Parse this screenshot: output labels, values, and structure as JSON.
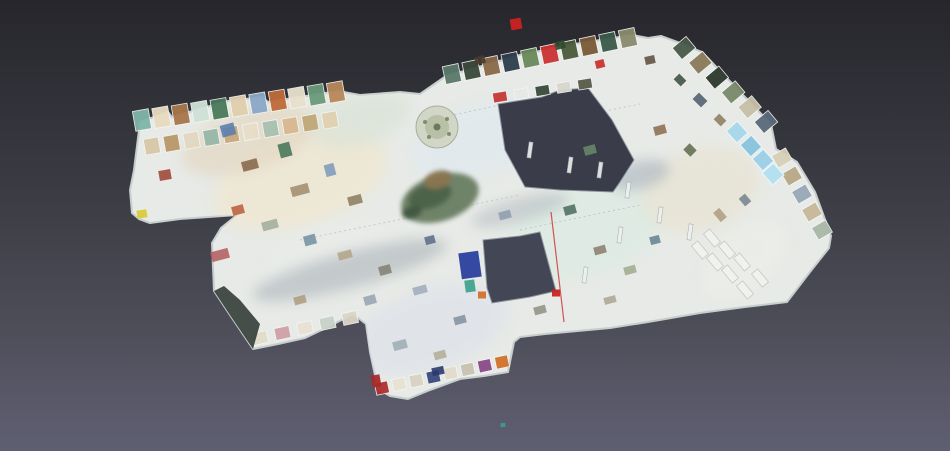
{
  "viewer": {
    "type": "3d-dollhouse-mesh-view",
    "background": {
      "top": "#26262c",
      "upper_mid": "#3a3a42",
      "lower_mid": "#4c4c57",
      "bottom": "#5f5f72"
    },
    "model_accent_colors": {
      "floor": "#e7eae6",
      "wall_edge": "#c6cdcd",
      "atrium_hole": "#3a3d49",
      "courtyard_hole": "#434654",
      "glass_roof": "#9ed0e6",
      "grotto_green": "#64785c",
      "alert_red": "#cc2222"
    }
  },
  "scene": {
    "plate": {
      "fill": "#e7eae6",
      "stroke": "#c6cdcd",
      "points": "140,122 168,112 172,117 210,106 228,101 262,97 268,102 338,91 360,95 400,92 420,94 446,76 475,68 520,55 575,44 632,35 648,38 661,36 680,43 702,52 744,96 771,124 776,149 797,162 815,192 831,236 829,248 810,272 787,302 745,307 700,313 648,322 610,328 545,334 520,337 514,342 508,372 484,376 460,379 430,390 408,399 390,396 378,389 370,352 366,324 353,314 330,326 305,338 278,344 253,349 232,318 214,291 212,243 221,228 237,215 180,219 150,223 139,219 132,213 130,190 134,170"
    },
    "holes": [
      {
        "name": "atrium-hole",
        "fill": "#3a3d49",
        "points": "498,104 542,97 560,90 588,88 612,120 634,160 620,182 613,192 560,190 525,187 505,150"
      },
      {
        "name": "courtyard-hole",
        "fill": "#434654",
        "points": "483,240 520,236 540,232 553,280 556,291 530,297 492,303 487,288"
      }
    ],
    "corner_face": {
      "fill": "#333d36",
      "opacity": 0.9,
      "points": "214,291 232,318 253,349 260,324 240,300 224,286"
    },
    "tint_blobs": [
      {
        "cx": 300,
        "cy": 180,
        "rx": 90,
        "ry": 45,
        "rot": -18,
        "fill": "#efe7d2",
        "op": 0.8
      },
      {
        "cx": 250,
        "cy": 140,
        "rx": 70,
        "ry": 30,
        "rot": -18,
        "fill": "#e3d7c2",
        "op": 0.7
      },
      {
        "cx": 480,
        "cy": 140,
        "rx": 70,
        "ry": 35,
        "rot": -18,
        "fill": "#dfe9f0",
        "op": 0.7
      },
      {
        "cx": 585,
        "cy": 230,
        "rx": 80,
        "ry": 45,
        "rot": -18,
        "fill": "#dcebe3",
        "op": 0.8
      },
      {
        "cx": 700,
        "cy": 190,
        "rx": 60,
        "ry": 40,
        "rot": -18,
        "fill": "#e8e3d2",
        "op": 0.7
      },
      {
        "cx": 430,
        "cy": 330,
        "rx": 80,
        "ry": 40,
        "rot": -18,
        "fill": "#dfe3ea",
        "op": 0.8
      },
      {
        "cx": 330,
        "cy": 260,
        "rx": 70,
        "ry": 35,
        "rot": -18,
        "fill": "#e9ecea",
        "op": 0.6
      },
      {
        "cx": 745,
        "cy": 260,
        "rx": 50,
        "ry": 28,
        "rot": -40,
        "fill": "#eceee9",
        "op": 0.7
      },
      {
        "cx": 360,
        "cy": 120,
        "rx": 50,
        "ry": 25,
        "rot": -18,
        "fill": "#d8e2d4",
        "op": 0.6
      },
      {
        "cx": 350,
        "cy": 270,
        "rx": 100,
        "ry": 18,
        "rot": -15,
        "fill": "#9aa2ab",
        "op": 0.45
      },
      {
        "cx": 520,
        "cy": 210,
        "rx": 50,
        "ry": 12,
        "rot": -15,
        "fill": "#a2a9b2",
        "op": 0.4
      },
      {
        "cx": 640,
        "cy": 175,
        "rx": 30,
        "ry": 14,
        "rot": -15,
        "fill": "#8a98a8",
        "op": 0.4
      }
    ],
    "seams": [
      {
        "x1": 300,
        "y1": 240,
        "x2": 520,
        "y2": 195
      },
      {
        "x1": 430,
        "y1": 120,
        "x2": 500,
        "y2": 105
      },
      {
        "x1": 520,
        "y1": 230,
        "x2": 640,
        "y2": 205
      },
      {
        "x1": 560,
        "y1": 120,
        "x2": 640,
        "y2": 104
      }
    ],
    "strips": [
      {
        "name": "left-wing-top-rooms",
        "x1": 142,
        "y1": 120,
        "x2": 336,
        "y2": 92,
        "w": 16,
        "h": 20,
        "rot": -10,
        "colors": [
          "#7fb6a8",
          "#e8dcc0",
          "#a8764a",
          "#cfe2d8",
          "#4a7a5a",
          "#e0cfae",
          "#8aa8c8",
          "#c06a3a",
          "#e8e0cc",
          "#6a9a7a",
          "#b8885a"
        ]
      },
      {
        "name": "left-wing-second-rooms",
        "x1": 152,
        "y1": 146,
        "x2": 330,
        "y2": 120,
        "w": 15,
        "h": 16,
        "rot": -10,
        "colors": [
          "#d8c8a8",
          "#b89868",
          "#e2d8c2",
          "#98b8a8",
          "#caa87a",
          "#e8ddc8",
          "#a8c0b0",
          "#d8b890",
          "#c0a878",
          "#e0d0b0"
        ]
      },
      {
        "name": "upper-gallery-rooms",
        "x1": 452,
        "y1": 74,
        "x2": 628,
        "y2": 38,
        "w": 16,
        "h": 18,
        "rot": -12,
        "colors": [
          "#5a7a6a",
          "#3a4a3a",
          "#8a6a4a",
          "#2e3e4e",
          "#6a8a5a",
          "#cc3333",
          "#4a5a3a",
          "#7a5a3a",
          "#3a5a4a",
          "#8a8a6a"
        ]
      },
      {
        "name": "right-wing-top-rooms",
        "x1": 684,
        "y1": 48,
        "x2": 766,
        "y2": 122,
        "w": 15,
        "h": 18,
        "rot": 50,
        "colors": [
          "#4a5a4a",
          "#8a7a5a",
          "#2e3a2e",
          "#7a8a6a",
          "#c8c0a8",
          "#5a6a7a"
        ]
      },
      {
        "name": "right-edge-rooms",
        "x1": 782,
        "y1": 158,
        "x2": 822,
        "y2": 230,
        "w": 14,
        "h": 16,
        "rot": 60,
        "colors": [
          "#d8d0b8",
          "#b8a888",
          "#98a8b8",
          "#c8b898",
          "#a8b8a8"
        ]
      },
      {
        "name": "south-annex-edge-rooms",
        "x1": 382,
        "y1": 388,
        "x2": 502,
        "y2": 362,
        "w": 13,
        "h": 12,
        "rot": -12,
        "colors": [
          "#b03030",
          "#e8e2d2",
          "#d8d2c2",
          "#3a4a7e",
          "#e2dccc",
          "#c8c2b2",
          "#8a4a8a",
          "#d2722a"
        ]
      },
      {
        "name": "southwest-corner-rooms",
        "x1": 260,
        "y1": 338,
        "x2": 350,
        "y2": 318,
        "w": 15,
        "h": 12,
        "rot": -12,
        "colors": [
          "#e2dccc",
          "#d0a0a8",
          "#e8e2d2",
          "#c8d2c8",
          "#dcd6c6"
        ]
      },
      {
        "name": "atrium-rim-rooms",
        "x1": 500,
        "y1": 97,
        "x2": 585,
        "y2": 84,
        "w": 14,
        "h": 10,
        "rot": -9,
        "colors": [
          "#c43a35",
          "#e8e8e8",
          "#3a4a3a",
          "#d8d8d0",
          "#5a5a4a"
        ]
      }
    ],
    "exhibits": [
      {
        "x": 228,
        "y": 130,
        "w": 14,
        "h": 12,
        "r": -15,
        "f": "#5a80b0",
        "o": 0.9
      },
      {
        "x": 250,
        "y": 165,
        "w": 16,
        "h": 10,
        "r": -15,
        "f": "#8a6a4e",
        "o": 0.9
      },
      {
        "x": 285,
        "y": 150,
        "w": 12,
        "h": 14,
        "r": -15,
        "f": "#49795c",
        "o": 0.9
      },
      {
        "x": 300,
        "y": 190,
        "w": 18,
        "h": 10,
        "r": -15,
        "f": "#a08a6a",
        "o": 0.85
      },
      {
        "x": 330,
        "y": 170,
        "w": 10,
        "h": 12,
        "r": -15,
        "f": "#7a98b8",
        "o": 0.85
      },
      {
        "x": 355,
        "y": 200,
        "w": 14,
        "h": 9,
        "r": -15,
        "f": "#8a7a5a",
        "o": 0.85
      },
      {
        "x": 238,
        "y": 210,
        "w": 12,
        "h": 9,
        "r": -15,
        "f": "#b85a3a",
        "o": 0.85
      },
      {
        "x": 270,
        "y": 225,
        "w": 16,
        "h": 9,
        "r": -15,
        "f": "#9aa89a",
        "o": 0.8
      },
      {
        "x": 310,
        "y": 240,
        "w": 12,
        "h": 10,
        "r": -15,
        "f": "#6a8a9a",
        "o": 0.8
      },
      {
        "x": 345,
        "y": 255,
        "w": 14,
        "h": 8,
        "r": -15,
        "f": "#b0a080",
        "o": 0.8
      },
      {
        "x": 385,
        "y": 270,
        "w": 12,
        "h": 9,
        "r": -15,
        "f": "#7a7a6a",
        "o": 0.8
      },
      {
        "x": 420,
        "y": 290,
        "w": 14,
        "h": 8,
        "r": -15,
        "f": "#98a8b8",
        "o": 0.8
      },
      {
        "x": 370,
        "y": 300,
        "w": 12,
        "h": 9,
        "r": -15,
        "f": "#8a98a8",
        "o": 0.75
      },
      {
        "x": 300,
        "y": 300,
        "w": 12,
        "h": 8,
        "r": -15,
        "f": "#a89878",
        "o": 0.8
      },
      {
        "x": 430,
        "y": 240,
        "w": 10,
        "h": 8,
        "r": -15,
        "f": "#5a6a8a",
        "o": 0.85
      },
      {
        "x": 505,
        "y": 215,
        "w": 12,
        "h": 8,
        "r": -15,
        "f": "#8a9aaa",
        "o": 0.8
      },
      {
        "x": 570,
        "y": 210,
        "w": 12,
        "h": 9,
        "r": -15,
        "f": "#4a6a5a",
        "o": 0.85
      },
      {
        "x": 600,
        "y": 250,
        "w": 12,
        "h": 8,
        "r": -15,
        "f": "#8a7a6a",
        "o": 0.85
      },
      {
        "x": 630,
        "y": 270,
        "w": 12,
        "h": 8,
        "r": -15,
        "f": "#98a888",
        "o": 0.8
      },
      {
        "x": 655,
        "y": 240,
        "w": 10,
        "h": 8,
        "r": -15,
        "f": "#5a7a8a",
        "o": 0.8
      },
      {
        "x": 610,
        "y": 300,
        "w": 12,
        "h": 7,
        "r": -15,
        "f": "#a8a090",
        "o": 0.8
      },
      {
        "x": 540,
        "y": 310,
        "w": 12,
        "h": 8,
        "r": -15,
        "f": "#8a8a7a",
        "o": 0.8
      },
      {
        "x": 460,
        "y": 320,
        "w": 12,
        "h": 8,
        "r": -15,
        "f": "#7a8a98",
        "o": 0.8
      },
      {
        "x": 400,
        "y": 345,
        "w": 14,
        "h": 9,
        "r": -15,
        "f": "#9aa8b0",
        "o": 0.8
      },
      {
        "x": 440,
        "y": 355,
        "w": 12,
        "h": 8,
        "r": -15,
        "f": "#b0a890",
        "o": 0.8
      },
      {
        "x": 590,
        "y": 150,
        "w": 12,
        "h": 9,
        "r": -15,
        "f": "#6a8a6a",
        "o": 0.85
      },
      {
        "x": 660,
        "y": 130,
        "w": 12,
        "h": 9,
        "r": -15,
        "f": "#8a6a4a",
        "o": 0.85
      },
      {
        "x": 690,
        "y": 150,
        "w": 10,
        "h": 9,
        "r": 45,
        "f": "#5a6a4a",
        "o": 0.85
      },
      {
        "x": 700,
        "y": 100,
        "w": 12,
        "h": 9,
        "r": 45,
        "f": "#4a5a6a",
        "o": 0.85
      },
      {
        "x": 720,
        "y": 120,
        "w": 10,
        "h": 8,
        "r": 45,
        "f": "#8a7a5a",
        "o": 0.85
      },
      {
        "x": 680,
        "y": 80,
        "w": 10,
        "h": 8,
        "r": 45,
        "f": "#3a4a3a",
        "o": 0.85
      },
      {
        "x": 650,
        "y": 60,
        "w": 10,
        "h": 8,
        "r": -12,
        "f": "#5a4a3a",
        "o": 0.85
      },
      {
        "x": 720,
        "y": 215,
        "w": 12,
        "h": 8,
        "r": 50,
        "f": "#a89878",
        "o": 0.8
      },
      {
        "x": 745,
        "y": 200,
        "w": 10,
        "h": 8,
        "r": 50,
        "f": "#6a7a8a",
        "o": 0.8
      },
      {
        "x": 165,
        "y": 175,
        "w": 12,
        "h": 10,
        "r": -10,
        "f": "#a04a3a",
        "o": 0.9
      },
      {
        "x": 220,
        "y": 255,
        "w": 18,
        "h": 10,
        "r": -15,
        "f": "#b05a5a",
        "o": 0.85
      },
      {
        "x": 142,
        "y": 214,
        "w": 10,
        "h": 8,
        "r": -10,
        "f": "#d8cc3a",
        "o": 0.95
      },
      {
        "x": 482,
        "y": 295,
        "w": 8,
        "h": 7,
        "r": 0,
        "f": "#d2722a",
        "o": 0.95
      },
      {
        "x": 470,
        "y": 265,
        "w": 20,
        "h": 26,
        "r": -8,
        "f": "#2b3f9e",
        "o": 0.95
      },
      {
        "x": 470,
        "y": 286,
        "w": 10,
        "h": 12,
        "r": -8,
        "f": "#3aa08a",
        "o": 0.9
      },
      {
        "x": 516,
        "y": 24,
        "w": 11,
        "h": 11,
        "r": -10,
        "f": "#cc2222",
        "o": 0.95
      },
      {
        "x": 600,
        "y": 64,
        "w": 9,
        "h": 8,
        "r": -14,
        "f": "#cc3333",
        "o": 0.95
      },
      {
        "x": 556,
        "y": 293,
        "w": 8,
        "h": 7,
        "r": 0,
        "f": "#cc2222",
        "o": 0.95
      },
      {
        "x": 376,
        "y": 381,
        "w": 9,
        "h": 12,
        "r": -10,
        "f": "#a82a2a",
        "o": 0.95
      },
      {
        "x": 438,
        "y": 371,
        "w": 12,
        "h": 8,
        "r": -12,
        "f": "#2a3a6e",
        "o": 0.9
      },
      {
        "x": 503,
        "y": 425,
        "w": 5,
        "h": 4,
        "r": 0,
        "f": "#3aa08a",
        "o": 0.9
      },
      {
        "x": 560,
        "y": 45,
        "w": 10,
        "h": 8,
        "r": -14,
        "f": "#2e4a2e",
        "o": 0.9
      },
      {
        "x": 480,
        "y": 60,
        "w": 10,
        "h": 8,
        "r": -14,
        "f": "#4a3a2e",
        "o": 0.9
      }
    ],
    "wall_slivers": [
      {
        "x": 628,
        "y": 190
      },
      {
        "x": 600,
        "y": 170
      },
      {
        "x": 660,
        "y": 215
      },
      {
        "x": 690,
        "y": 232
      },
      {
        "x": 570,
        "y": 165
      },
      {
        "x": 530,
        "y": 150
      },
      {
        "x": 620,
        "y": 235
      },
      {
        "x": 585,
        "y": 275
      }
    ],
    "tables": {
      "fill": "#f2f2ee",
      "stroke": "#c2c8c2",
      "w": 17,
      "h": 8,
      "rot": 50,
      "positions": [
        {
          "x": 700,
          "y": 250
        },
        {
          "x": 715,
          "y": 262
        },
        {
          "x": 730,
          "y": 274
        },
        {
          "x": 712,
          "y": 238
        },
        {
          "x": 727,
          "y": 250
        },
        {
          "x": 742,
          "y": 262
        },
        {
          "x": 745,
          "y": 290
        },
        {
          "x": 760,
          "y": 278
        }
      ]
    },
    "glass_roof": {
      "stroke": "#eaf5f9",
      "w": 16,
      "h": 15,
      "rot": 48,
      "panels": [
        {
          "x": 737,
          "y": 132,
          "f": "#a8d8ec"
        },
        {
          "x": 751,
          "y": 146,
          "f": "#8cc4de"
        },
        {
          "x": 763,
          "y": 160,
          "f": "#9ed0e6"
        },
        {
          "x": 773,
          "y": 174,
          "f": "#b4e0f0"
        }
      ]
    },
    "carousel": {
      "cx": 437,
      "cy": 127,
      "r_outer": 21,
      "r_inner": 12,
      "fill_outer": "#d2d6c6",
      "fill_inner": "#b8c0a8",
      "stroke": "#a8ae9c",
      "hub": "#6a7a5a"
    },
    "grotto": {
      "blobs": [
        {
          "cx": 440,
          "cy": 198,
          "rx": 40,
          "ry": 23,
          "rot": -18,
          "f": "#64785c",
          "o": 0.9
        },
        {
          "cx": 430,
          "cy": 196,
          "rx": 22,
          "ry": 12,
          "rot": -18,
          "f": "#4c6248",
          "o": 0.95
        },
        {
          "cx": 438,
          "cy": 180,
          "rx": 14,
          "ry": 9,
          "rot": -18,
          "f": "#8a7450",
          "o": 0.95
        },
        {
          "cx": 412,
          "cy": 212,
          "rx": 10,
          "ry": 6,
          "rot": -18,
          "f": "#3e523c",
          "o": 0.9
        }
      ]
    },
    "red_scan_line": {
      "x1": 551,
      "y1": 212,
      "x2": 564,
      "y2": 322,
      "stroke": "#cc2222",
      "width": 1.2,
      "op": 0.75
    }
  }
}
